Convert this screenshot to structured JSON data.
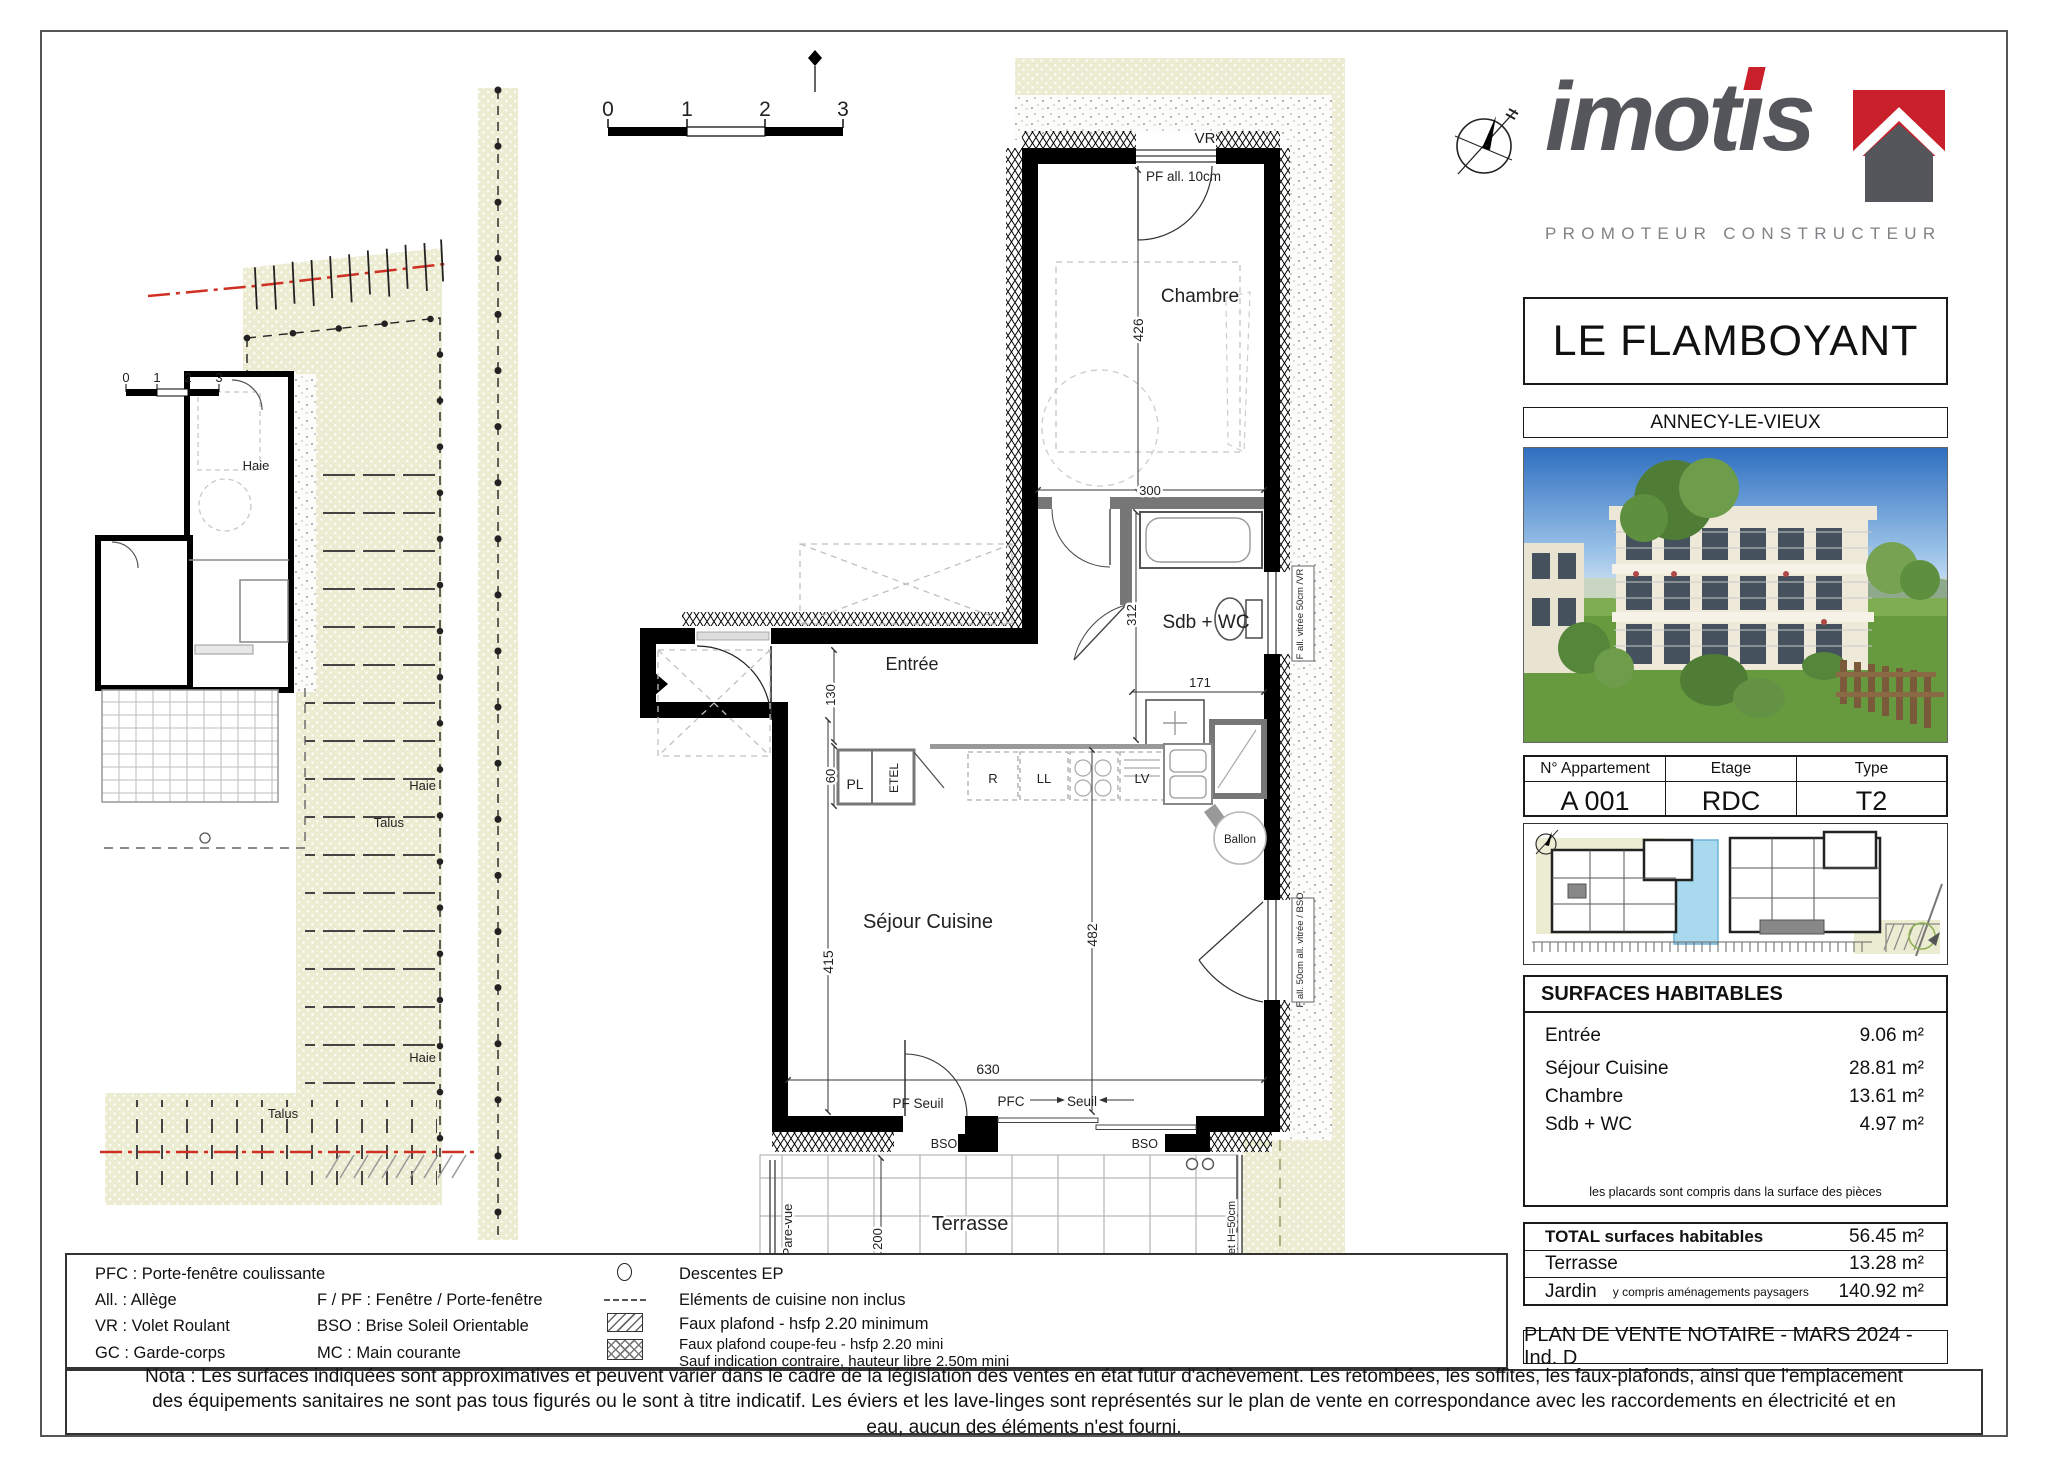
{
  "logo": {
    "part1": "imot",
    "part2": "ı",
    "part3": "s",
    "tagline": "PROMOTEUR CONSTRUCTEUR"
  },
  "title_block": {
    "name": "LE FLAMBOYANT",
    "city": "ANNECY-LE-VIEUX"
  },
  "apartment_table": {
    "headers": [
      "N° Appartement",
      "Etage",
      "Type"
    ],
    "number": "A 001",
    "floor": "RDC",
    "type": "T2"
  },
  "surfaces": {
    "title": "SURFACES HABITABLES",
    "rows": [
      {
        "label": "Entrée",
        "value": "9.06 m²"
      },
      {
        "label": "Séjour Cuisine",
        "value": "28.81 m²"
      },
      {
        "label": "Chambre",
        "value": "13.61 m²"
      },
      {
        "label": "Sdb + WC",
        "value": "4.97 m²"
      }
    ],
    "note": "les placards sont compris dans la surface des pièces"
  },
  "totals": {
    "total_label": "TOTAL surfaces habitables",
    "total_value": "56.45 m²",
    "terrasse_label": "Terrasse",
    "terrasse_value": "13.28 m²",
    "jardin_label": "Jardin",
    "jardin_sub": "y compris aménagements paysagers",
    "jardin_value": "140.92 m²"
  },
  "stamp": "PLAN DE VENTE NOTAIRE - MARS 2024 - Ind. D",
  "legend": {
    "abbr1": "PFC : Porte-fenêtre coulissante",
    "abbr2": "All. : Allège",
    "abbr3": "F / PF : Fenêtre / Porte-fenêtre",
    "abbr4": "VR : Volet Roulant",
    "abbr5": "BSO : Brise Soleil Orientable",
    "abbr6": "GC : Garde-corps",
    "abbr7": "MC : Main courante",
    "sym_ep": "Descentes EP",
    "sym_cuisine": "Eléments de cuisine non inclus",
    "sym_plafond": "Faux plafond - hsfp 2.20 minimum",
    "sym_coupefeu": "Faux plafond coupe-feu - hsfp 2.20 mini",
    "sym_note": "Sauf indication contraire, hauteur libre 2.50m mini"
  },
  "nota": "Nota : Les surfaces indiquées sont approximatives et peuvent varier dans le cadre de la législation des ventes en état futur d'achèvement. Les retombées, les soffites, les faux-plafonds, ainsi que l'emplacement des équipements sanitaires ne sont pas tous figurés ou le sont à titre indicatif. Les éviers et les lave-linges sont représentés sur le plan de vente en correspondance avec les raccordements en électricité et en eau, aucun des éléments n'est fourni.",
  "scale": {
    "t0": "0",
    "t1": "1",
    "t2": "2",
    "t3": "3"
  },
  "plan": {
    "labels": {
      "vr": "VR",
      "pf_all10": "PF all. 10cm",
      "chambre": "Chambre",
      "d426": "426",
      "d300": "300",
      "sdb": "Sdb + WC",
      "d312": "312",
      "d171": "171",
      "f_vitree_vr": "F all. vitrée 50cm /VR",
      "entree": "Entrée",
      "d130": "130",
      "d60": "60",
      "pl": "PL",
      "etel": "ETEL",
      "kit_r": "R",
      "kit_ll": "LL",
      "kit_lv": "LV",
      "ballon": "Ballon",
      "sejour": "Séjour Cuisine",
      "d415": "415",
      "d482": "482",
      "d630": "630",
      "f_bso": "F all. 50cm all. vitrée / BSO",
      "pf_seuil": "PF Seuil",
      "pfc": "PFC",
      "seuil": "Seuil",
      "bso": "BSO",
      "terrasse": "Terrasse",
      "d200": "200",
      "d660": "660",
      "pare_vue": "Pare-vue",
      "muret": "Muret H=50cm",
      "claustra": "Claustra"
    }
  },
  "siteplan": {
    "haie": "Haie",
    "talus": "Talus"
  }
}
